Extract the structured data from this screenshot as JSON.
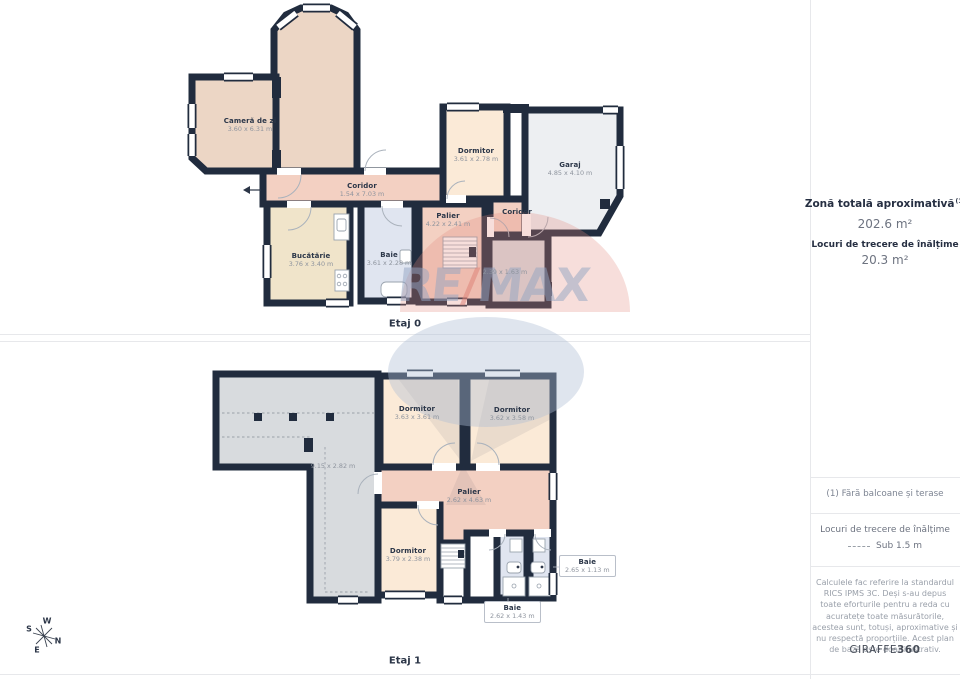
{
  "colors": {
    "wall": "#212c3e",
    "living_fill": "#ecd6c5",
    "corridor_fill": "#f3d0c2",
    "kitchen_fill": "#f0e4ca",
    "bedroom_fill": "#fbead7",
    "bath_fill": "#e0e5f0",
    "garage_fill": "#edeff2",
    "attic_fill": "#d8dbde",
    "watermark_red": "#e28a7c",
    "watermark_blue": "#b0bfd5"
  },
  "floor0": {
    "title": "Etaj 0",
    "rooms": {
      "camera_de_zi": {
        "name": "Cameră de zi",
        "dims": "3.60 x 6.31 m"
      },
      "coridor": {
        "name": "Coridor",
        "dims": "1.54 x 7.03 m"
      },
      "dormitor": {
        "name": "Dormitor",
        "dims": "3.61 x 2.78 m"
      },
      "garaj": {
        "name": "Garaj",
        "dims": "4.85 x 4.10 m"
      },
      "palier": {
        "name": "Palier",
        "dims": "4.22 x 2.41 m"
      },
      "coridor_mic": {
        "name": "Coridor",
        "dims": ""
      },
      "camera_tehnica": {
        "name": "",
        "dims": "2.39 x 1.63 m"
      },
      "bucatarie": {
        "name": "Bucătărie",
        "dims": "3.76 x 3.40 m"
      },
      "baie": {
        "name": "Baie",
        "dims": "3.61 x 2.28 m"
      }
    }
  },
  "floor1": {
    "title": "Etaj 1",
    "rooms": {
      "pod": {
        "name": "",
        "dims": "9.15 x 2.82 m"
      },
      "dormitor_stanga": {
        "name": "Dormitor",
        "dims": "3.63 x 3.61 m"
      },
      "dormitor_dreapta": {
        "name": "Dormitor",
        "dims": "3.62 x 3.58 m"
      },
      "palier": {
        "name": "Palier",
        "dims": "2.62 x 4.63 m"
      },
      "dormitor_jos": {
        "name": "Dormitor",
        "dims": "3.79 x 2.38 m"
      },
      "baie_dreapta": {
        "name": "Baie",
        "dims": "2.65 x 1.13 m"
      },
      "baie_jos": {
        "name": "Baie",
        "dims": "2.62 x 1.43 m"
      }
    }
  },
  "sidebar": {
    "total_area_label": "Zonă totală aproximativă",
    "total_area_footnote": "(1)",
    "total_area_value": "202.6 m²",
    "passage_area_label": "Locuri de trecere de înălțime",
    "passage_area_value": "20.3 m²",
    "footnote": "(1) Fără balcoane și terase",
    "legend_title": "Locuri de trecere de înălțime",
    "legend_value": "Sub 1.5 m",
    "disclaimer": "Calculele fac referire la standardul RICS IPMS 3C. Deși s-au depus toate eforturile pentru a reda cu acuratețe toate măsurătorile, acestea sunt, totuși, aproximative și nu respectă proporțiile. Acest plan de bază este doar ilustrativ.",
    "brand_name": "GIRAFFE",
    "brand_suffix": "360"
  },
  "compass": {
    "north": "N",
    "south": "S",
    "east": "E",
    "west": "W"
  },
  "watermark": {
    "part1": "RE",
    "slash": "/",
    "part2": "MAX"
  }
}
